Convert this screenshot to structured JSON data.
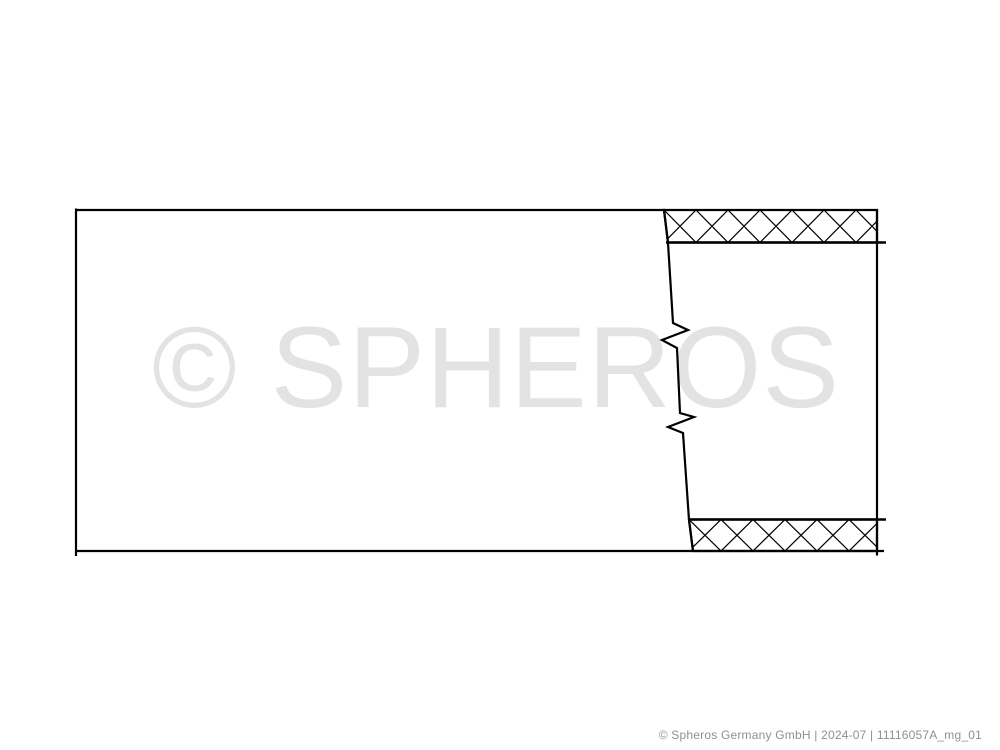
{
  "drawing": {
    "type": "technical-line-drawing",
    "subject": "pipe-with-break-and-cross-hatched-wall-section",
    "watermark": "© SPHEROS",
    "colors": {
      "background": "#ffffff",
      "line": "#000000",
      "watermark": "#e3e3e3",
      "footer": "#909090"
    }
  },
  "footer": {
    "text": "© Spheros Germany GmbH | 2024-07 | 11116057A_mg_01"
  }
}
